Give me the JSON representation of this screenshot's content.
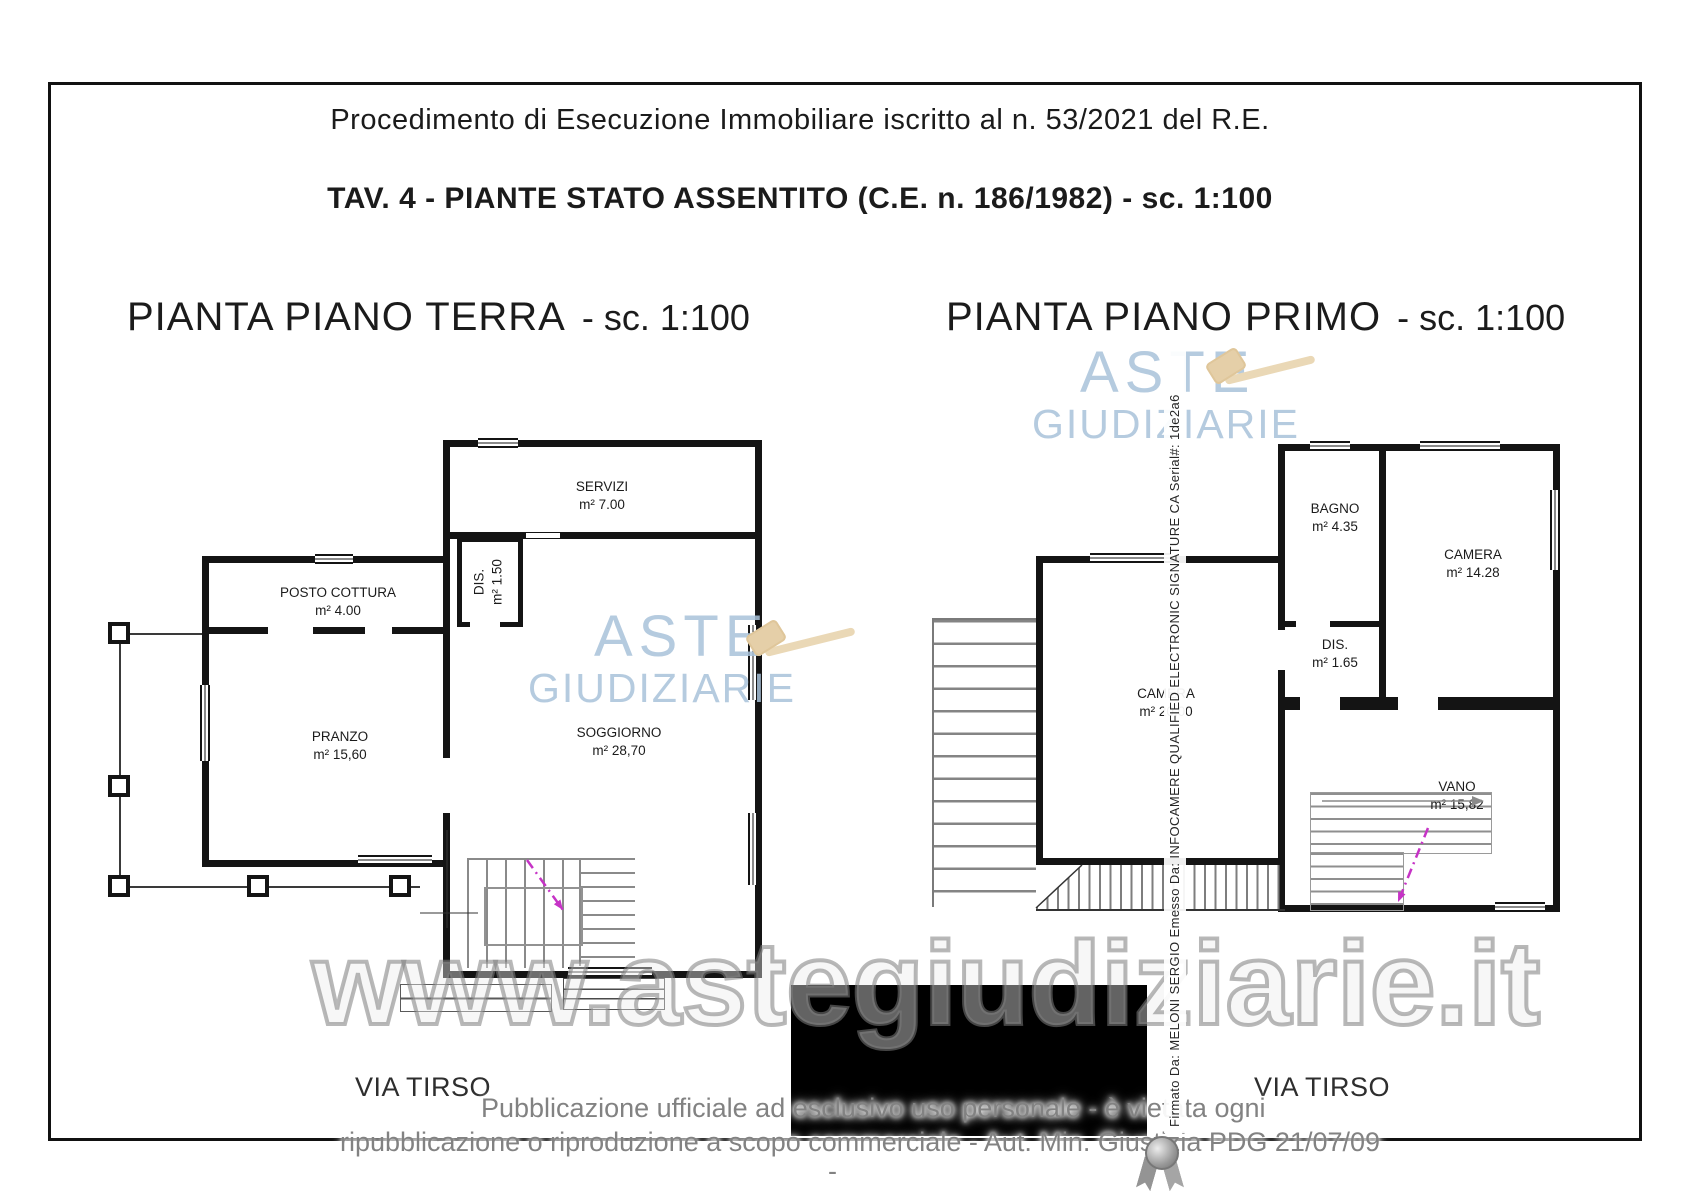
{
  "header": {
    "procedure_title": "Procedimento di Esecuzione Immobiliare iscritto al n. 53/2021 del R.E.",
    "sheet_title": "TAV. 4 - PIANTE STATO ASSENTITO (C.E. n. 186/1982)  - sc. 1:100"
  },
  "plans": {
    "terra": {
      "title": "PIANTA PIANO TERRA",
      "scale_note": "- sc. 1:100",
      "street_label": "VIA TIRSO",
      "rooms": [
        {
          "name": "SERVIZI",
          "area": "m² 7.00"
        },
        {
          "name": "POSTO COTTURA",
          "area": "m² 4.00"
        },
        {
          "name": "DIS.",
          "area": "m² 1.50"
        },
        {
          "name": "PRANZO",
          "area": "m² 15,60"
        },
        {
          "name": "SOGGIORNO",
          "area": "m²  28,70"
        }
      ]
    },
    "primo": {
      "title": "PIANTA PIANO PRIMO",
      "scale_note": "- sc. 1:100",
      "street_label": "VIA TIRSO",
      "rooms": [
        {
          "name": "BAGNO",
          "area": "m² 4.35"
        },
        {
          "name": "CAMERA",
          "area": "m² 14.28"
        },
        {
          "name": "DIS.",
          "area": "m² 1.65"
        },
        {
          "name": "CAMERA",
          "area": "m² 20,00"
        },
        {
          "name": "VANO",
          "area": "m² 15,82"
        }
      ]
    }
  },
  "watermarks": {
    "brand_line1": "ASTE",
    "brand_line2": "GIUDIZIARIE",
    "website": "www.astegiudiziarie.it",
    "brand_color": "#a9c2da",
    "gavel_color": "#e8d4b0",
    "site_color": "#9a9a9a"
  },
  "signature": {
    "vertical_text": "Firmato Da: MELONI SERGIO Emesso Da: INFOCAMERE QUALIFIED ELECTRONIC SIGNATURE CA Serial#: 1de2a6"
  },
  "footer": {
    "disclaimer_line1": "Pubblicazione ufficiale ad esclusivo uso personale - è vietata ogni",
    "disclaimer_line2": "ripubblicazione o riproduzione a scopo commerciale - Aut. Min. Giustizia PDG 21/07/09",
    "dash": "-"
  },
  "drawing": {
    "wall_color": "#141414",
    "stair_gray": "#8a8a8a",
    "accent_magenta": "#c633c6"
  }
}
